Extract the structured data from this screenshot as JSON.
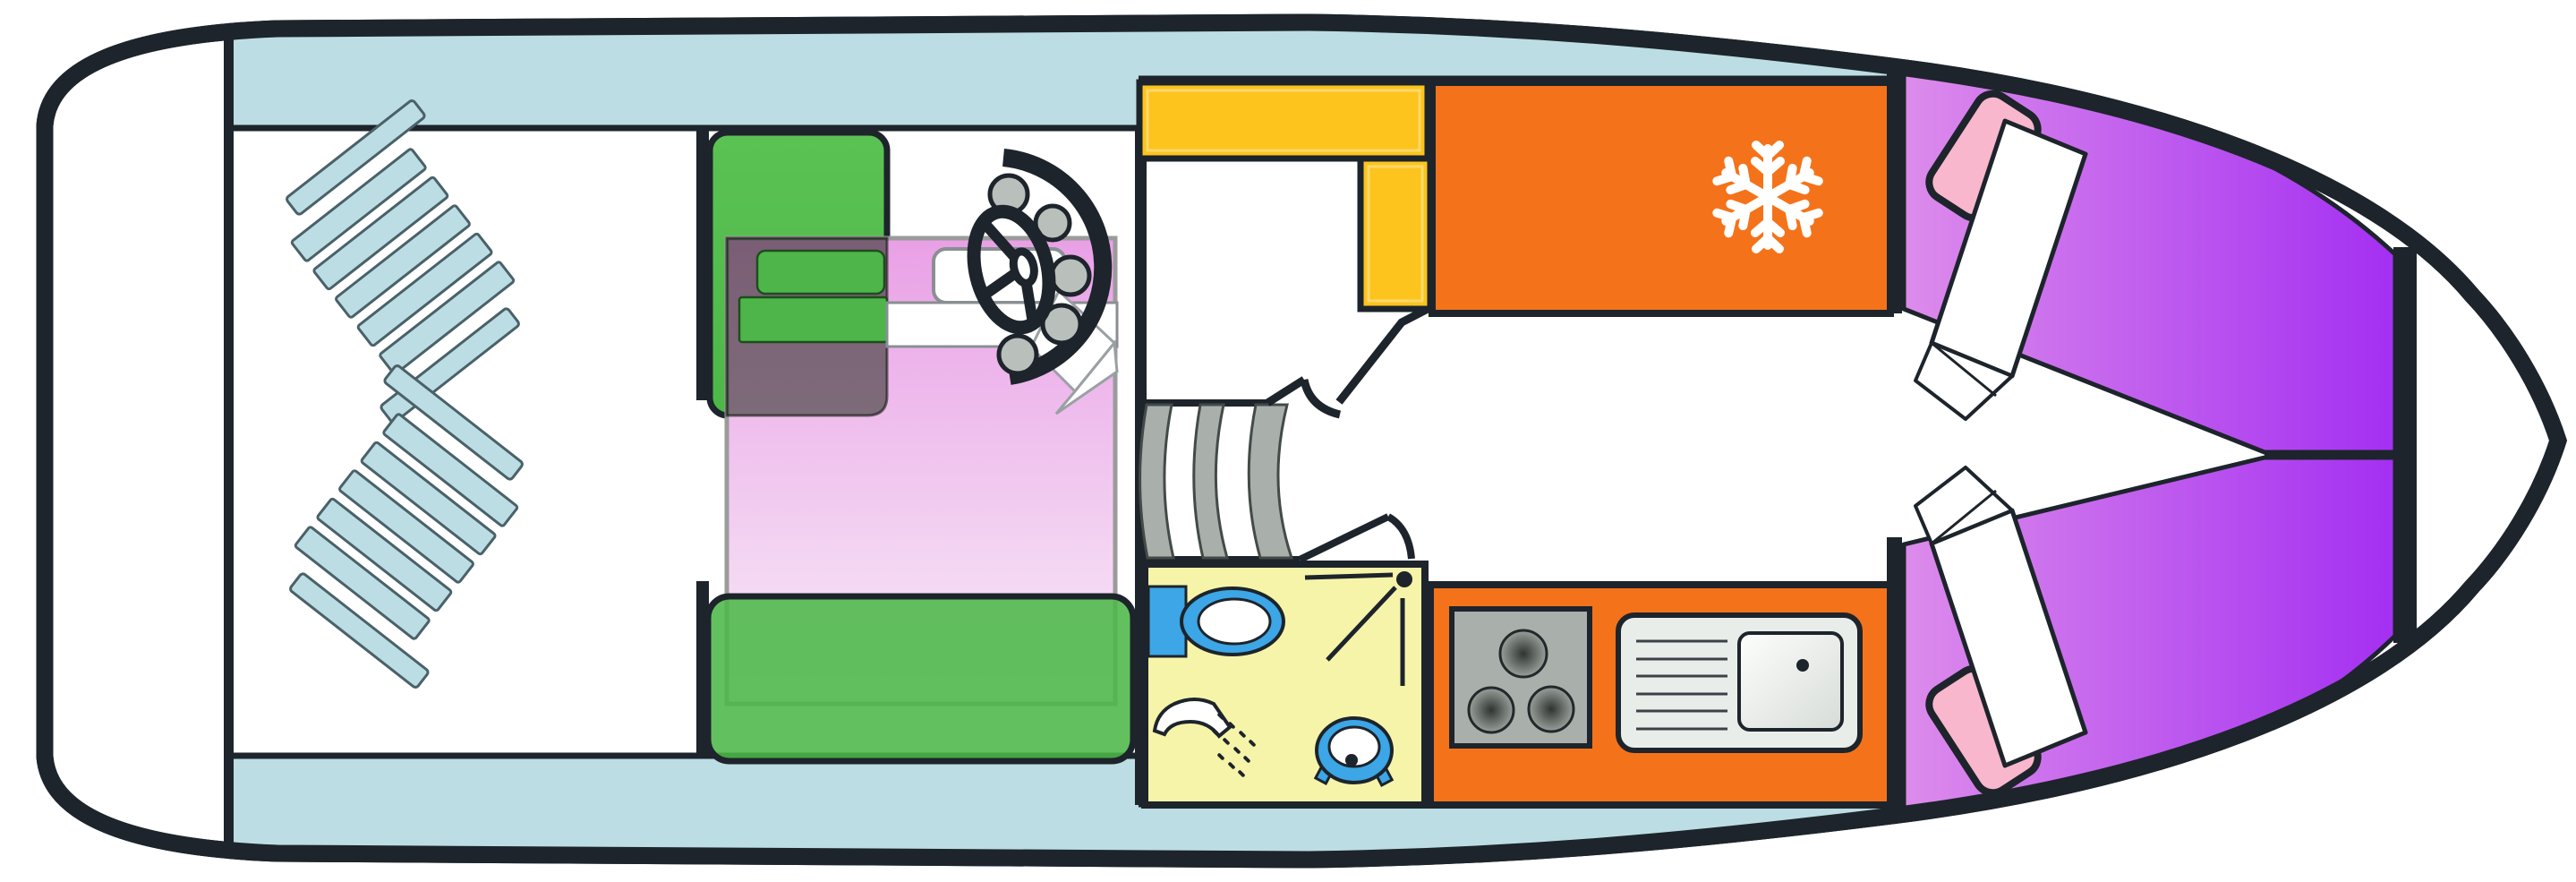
{
  "diagram": {
    "type": "boat-floor-plan",
    "view": "top-down deck plan of a motor yacht",
    "orientation": "bow-right, stern-left",
    "aria_label": "Boat deck floor plan diagram"
  },
  "colors": {
    "outline": "#1d242b",
    "hull_fill": "#ffffff",
    "deck_trim": "#bcdde3",
    "sofa_green": "#4cb848",
    "table_overlay": "#15210f",
    "bed_pink_top": "#e9a0e6",
    "bed_pink_bottom": "#f8ecf8",
    "bed_border": "#9b9b9b",
    "berth_purple_light": "#dd8ceb",
    "berth_purple_deep": "#a12bf2",
    "pillow_pink": "#f8b7cd",
    "blanket_white": "#ffffff",
    "cabinet_yellow": "#fcc41d",
    "appliance_orange": "#f4731a",
    "bathroom_yellow": "#f6f4a9",
    "fixture_blue": "#3ca6e6",
    "steps_gray": "#a9b0ac",
    "gauge_gray": "#b9bfba",
    "stove_gray": "#a9afab",
    "burner_dark": "#2f3431",
    "burner_mid": "#6a706c",
    "burner_light": "#9aa09b",
    "sink_gray": "#e9ede9",
    "basin_light": "#fdfefd",
    "basin_shade": "#d7dcd8",
    "snowflake_white": "#ffffff"
  },
  "sections": {
    "swim_platform": {
      "label": "stern swim platform"
    },
    "cockpit": {
      "label": "aft cockpit",
      "deck_chairs": 2,
      "slats_per_chair": 5,
      "rails_per_chair": 2
    },
    "saloon": {
      "label": "saloon / aft cabin",
      "furniture": [
        "corner sofa",
        "table",
        "seat cushions",
        "convertible double bed",
        "pillow",
        "folded sheet",
        "bench sofa"
      ]
    },
    "helm": {
      "label": "helm station",
      "instrument_gauges": 5,
      "steering_wheel": 1,
      "console_arc": 1
    },
    "companionway": {
      "label": "companionway",
      "steps": 3,
      "door_swings": 2
    },
    "bathroom": {
      "label": "bathroom / head",
      "fixtures": [
        "vanity cabinet",
        "washbasin",
        "shower head",
        "toilet"
      ],
      "door_swing_lines": 3,
      "spray_dots": 11
    },
    "galley": {
      "label": "galley",
      "overhead_cabinet": 1,
      "side_cabinet": 1,
      "refrigerator": {
        "icon": "snowflake"
      },
      "stove_burners": 3,
      "sink": {
        "drainboard_lines": 6,
        "drain_dot": 1
      }
    },
    "bow_cabin": {
      "label": "bow V-berth cabin",
      "berths": 2,
      "pillows": 2,
      "blankets": 2
    }
  },
  "icons": {
    "snowflake": "refrigerator / freezer symbol",
    "steering_wheel": "helm position",
    "shower_head": "shower with spray",
    "toilet": "marine toilet",
    "washbasin": "oval basin"
  }
}
